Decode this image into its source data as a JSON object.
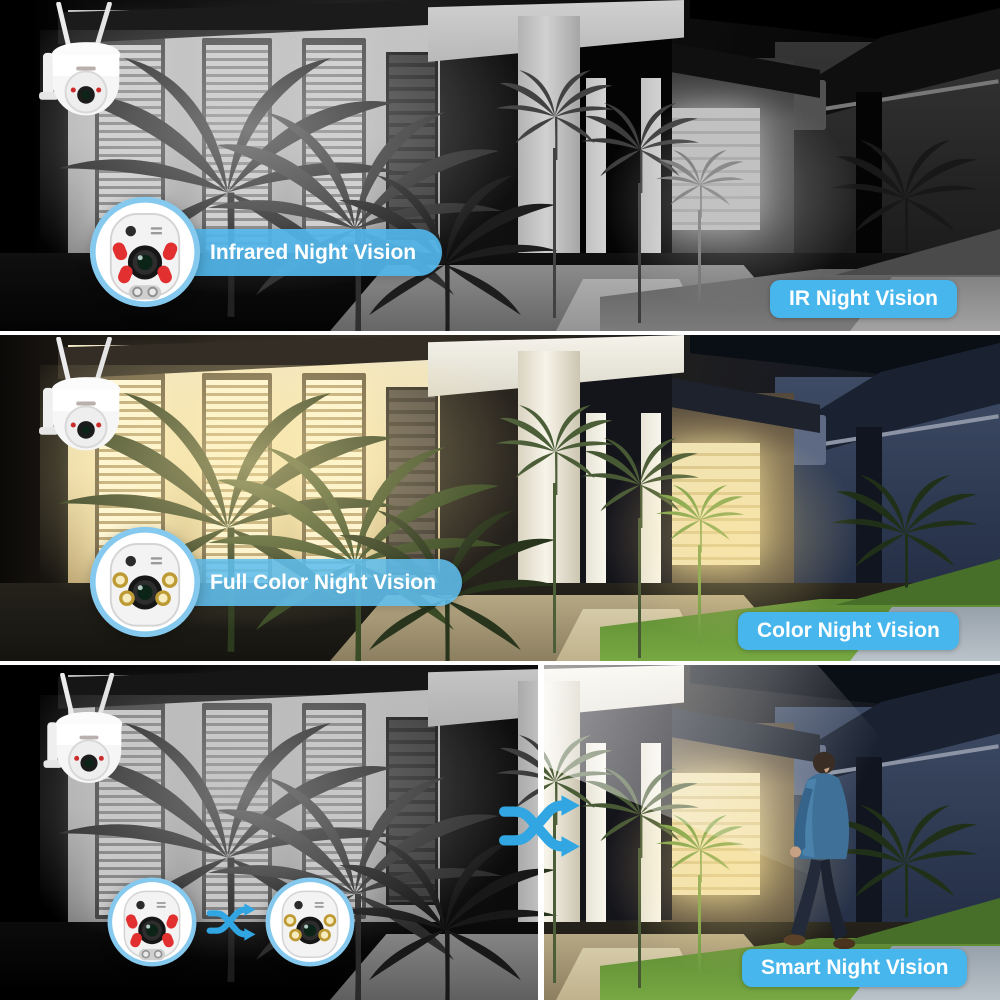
{
  "panels": {
    "ir": {
      "pill": "Infrared Night Vision",
      "badge": "IR Night Vision"
    },
    "full": {
      "pill": "Full Color Night Vision",
      "badge": "Color Night Vision"
    },
    "smart": {
      "badge": "Smart Night Vision"
    }
  },
  "colors": {
    "accent_blue": "#47b6ec",
    "pill_blue": "#52b5e8",
    "lens_ring_blue": "#86c9ee",
    "ir_led_red": "#e23030",
    "warm_led_gold": "#c9a23a",
    "warm_light": "#f5e9c2",
    "night_house_blue": "#2c3850",
    "grass_green": "#6fa23e"
  },
  "icons": {
    "swap_arrows": "two crossing shuffle arrows",
    "ir_lens": "camera lens close-up with red infrared LEDs",
    "color_lens": "camera lens close-up with warm white LEDs",
    "ptz_camera": "white wifi PTZ dome camera with two antennas",
    "person": "man in blue hooded jacket walking"
  },
  "scene": {
    "description": "house exterior at night: lit windows, entry portico, garage, palms, lawn",
    "panel1_style": "black and white infrared view",
    "panel2_style": "full color night view",
    "panel3_style": "split view: left black-and-white, right color with person"
  }
}
